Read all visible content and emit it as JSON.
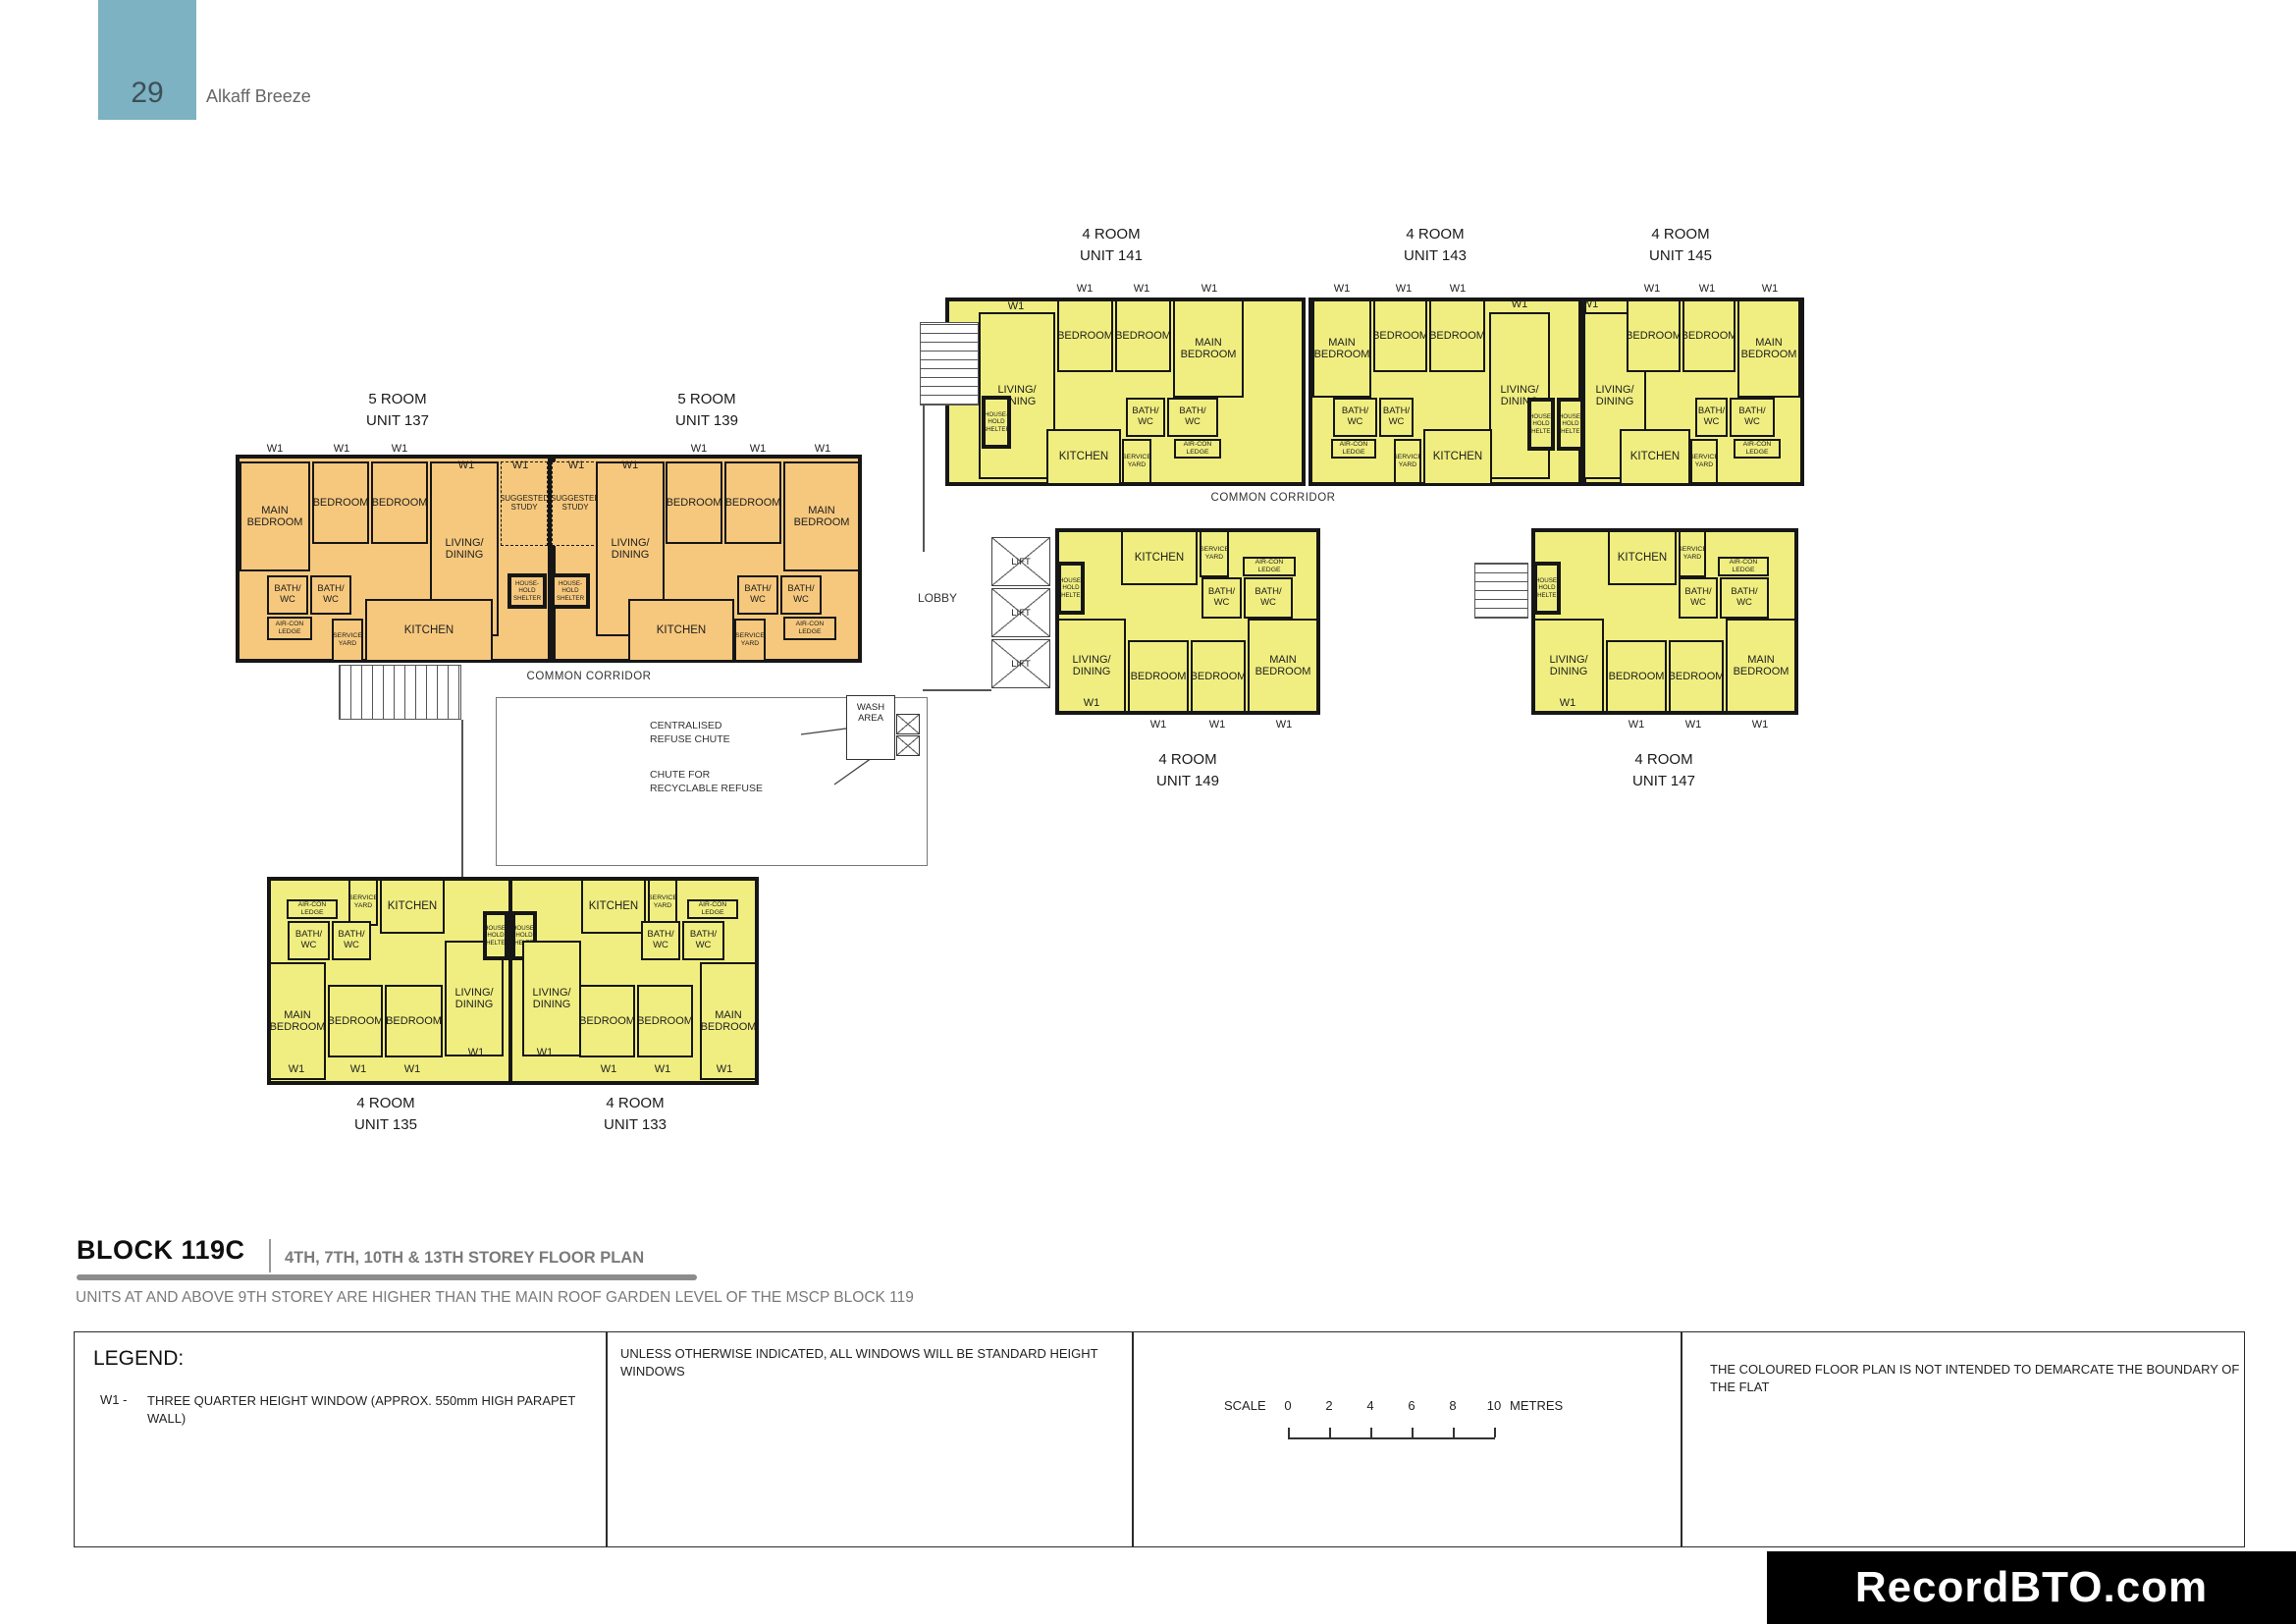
{
  "header": {
    "page_number": "29",
    "project_name": "Alkaff Breeze"
  },
  "plan": {
    "colors": {
      "five_room_fill": "#f6c87d",
      "four_room_fill": "#f0ee80",
      "wall": "#161616",
      "page_tab": "#7cb2c2"
    },
    "units": [
      {
        "type": "5 ROOM",
        "unit": "UNIT 137"
      },
      {
        "type": "5 ROOM",
        "unit": "UNIT 139"
      },
      {
        "type": "4 ROOM",
        "unit": "UNIT 141"
      },
      {
        "type": "4 ROOM",
        "unit": "UNIT 143"
      },
      {
        "type": "4 ROOM",
        "unit": "UNIT 145"
      },
      {
        "type": "4 ROOM",
        "unit": "UNIT 149"
      },
      {
        "type": "4 ROOM",
        "unit": "UNIT 147"
      },
      {
        "type": "4 ROOM",
        "unit": "UNIT 135"
      },
      {
        "type": "4 ROOM",
        "unit": "UNIT 133"
      }
    ],
    "room_labels": {
      "main_bedroom": "MAIN\nBEDROOM",
      "bedroom": "BEDROOM",
      "living_dining": "LIVING/\nDINING",
      "suggested_study": "SUGGESTED\nSTUDY",
      "bath_wc": "BATH/\nWC",
      "aircon_ledge": "AIR-CON\nLEDGE",
      "service_yard": "SERVICE\nYARD",
      "kitchen": "KITCHEN",
      "household_shelter": "HOUSE-\nHOLD\nSHELTER",
      "lift": "LIFT",
      "wash_area": "WASH\nAREA"
    },
    "annotations": {
      "common_corridor": "COMMON CORRIDOR",
      "lobby": "LOBBY",
      "window_code": "W1",
      "centralised_refuse_chute": "CENTRALISED\nREFUSE CHUTE",
      "recyclable_refuse_chute": "CHUTE FOR\nRECYCLABLE REFUSE"
    }
  },
  "footer": {
    "block_title": "BLOCK 119C",
    "storey_subtitle": "4TH, 7TH, 10TH & 13TH STOREY FLOOR PLAN",
    "roof_note": "UNITS AT AND ABOVE 9TH STOREY ARE HIGHER THAN THE MAIN ROOF GARDEN LEVEL OF THE MSCP BLOCK 119",
    "legend": {
      "title": "LEGEND:",
      "w1_code": "W1 -",
      "w1_text": "THREE QUARTER HEIGHT WINDOW (APPROX. 550mm HIGH PARAPET WALL)"
    },
    "windows_note": "UNLESS OTHERWISE INDICATED,  ALL WINDOWS WILL BE STANDARD HEIGHT WINDOWS",
    "scale": {
      "label": "SCALE",
      "ticks": [
        "0",
        "2",
        "4",
        "6",
        "8",
        "10"
      ],
      "unit": "METRES"
    },
    "boundary_note": "THE COLOURED FLOOR PLAN IS NOT INTENDED TO DEMARCATE THE BOUNDARY OF THE FLAT",
    "watermark": "RecordBTO.com"
  }
}
